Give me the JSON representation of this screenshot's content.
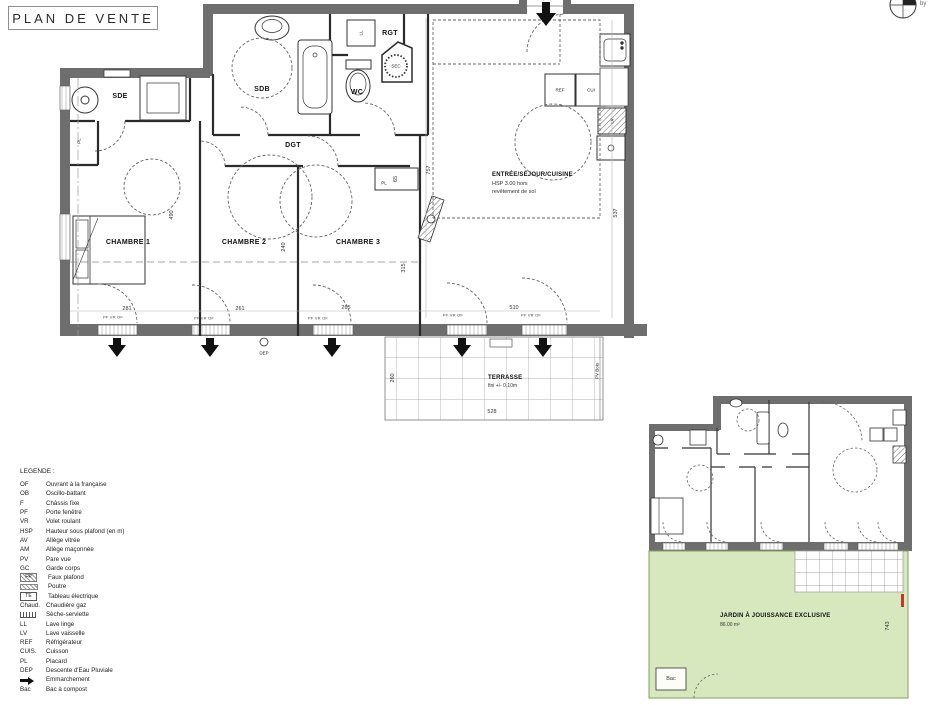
{
  "title": "PLAN DE VENTE",
  "compass": {
    "caption": "by"
  },
  "plan": {
    "rooms": {
      "sde": "SDE",
      "sdb": "SDB",
      "wc": "WC",
      "rgt": "RGT",
      "dgt": "DGT",
      "chambre1": "CHAMBRE 1",
      "chambre2": "CHAMBRE 2",
      "chambre3": "CHAMBRE 3",
      "sejour": "ENTRÉE/SÉJOUR/CUISINE",
      "sejour_line1": "HSP 3.00 hors",
      "sejour_line2": "revêtement de sol",
      "terrasse": "TERRASSE",
      "terrasse_sub": "fini +/- 0.10m"
    },
    "fixtures": {
      "ll": "LL",
      "sec": "SEC",
      "ref": "REF",
      "cui": "CUI",
      "lv": "LV",
      "pl": "PL",
      "pl2": "PL"
    },
    "windows_label": "PF VR OF",
    "dep": "DEP",
    "pv_bois": "PV Bois",
    "dims": {
      "chambre1_height": "490",
      "chambre2_height": "240",
      "chambre3_height": "315",
      "closet_depth": "65",
      "total_height": "757",
      "sejour_height": "537",
      "chambre1_width": "281",
      "chambre2_width": "261",
      "chambre3_width": "265",
      "sejour_width": "510",
      "terrasse_width": "528",
      "terrasse_depth": "260"
    }
  },
  "inset": {
    "jardin_title": "JARDIN À JOUISSANCE EXCLUSIVE",
    "jardin_area": "86.00 m²",
    "jardin_height": "743",
    "bac_label": "Bac"
  },
  "legend": {
    "title": "LEGENDE :",
    "items": [
      {
        "key": "OF",
        "label": "Ouvrant à la française",
        "sym": "text"
      },
      {
        "key": "OB",
        "label": "Oscillo-battant",
        "sym": "text"
      },
      {
        "key": "F",
        "label": "Châssis fixe",
        "sym": "text"
      },
      {
        "key": "PF",
        "label": "Porte fenêtre",
        "sym": "text"
      },
      {
        "key": "VR",
        "label": "Volet roulant",
        "sym": "text"
      },
      {
        "key": "HSP",
        "label": "Hauteur sous plafond (en m)",
        "sym": "text"
      },
      {
        "key": "AV",
        "label": "Allège vitrée",
        "sym": "text"
      },
      {
        "key": "AM",
        "label": "Allège maçonnée",
        "sym": "text"
      },
      {
        "key": "PV",
        "label": "Pare vue",
        "sym": "text"
      },
      {
        "key": "GC",
        "label": "Garde corps",
        "sym": "text"
      },
      {
        "key": "FP",
        "label": "Faux plafond",
        "sym": "hatch"
      },
      {
        "key": "",
        "label": "Poutre",
        "sym": "beam"
      },
      {
        "key": "TE",
        "label": "Tableau électrique",
        "sym": "box"
      },
      {
        "key": "Chaud.",
        "label": "Chaudière gaz",
        "sym": "text"
      },
      {
        "key": "",
        "label": "Sèche-serviette",
        "sym": "radiator"
      },
      {
        "key": "LL",
        "label": "Lave linge",
        "sym": "text"
      },
      {
        "key": "LV",
        "label": "Lave vaisselle",
        "sym": "text"
      },
      {
        "key": "REF",
        "label": "Réfrigérateur",
        "sym": "text"
      },
      {
        "key": "CUIS.",
        "label": "Cuisson",
        "sym": "text"
      },
      {
        "key": "PL",
        "label": "Placard",
        "sym": "text"
      },
      {
        "key": "DEP",
        "label": "Descente d'Eau Pluviale",
        "sym": "text"
      },
      {
        "key": "",
        "label": "Emmarchement",
        "sym": "arrow"
      },
      {
        "key": "Bac",
        "label": "Bac à compost",
        "sym": "text"
      }
    ]
  },
  "colors": {
    "wall": "#6e6e6e",
    "jardin": "#d7e8bf",
    "line": "#2b2b2b",
    "red_mark": "#c0392b"
  }
}
